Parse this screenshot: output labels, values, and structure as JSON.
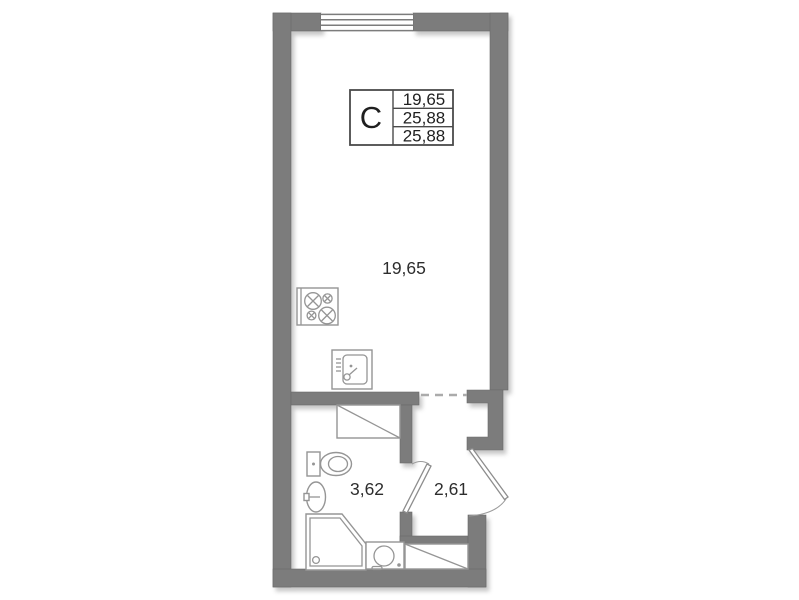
{
  "floorplan": {
    "unit_type_label": "C",
    "area_table": {
      "rows": [
        "19,65",
        "25,88",
        "25,88"
      ]
    },
    "rooms": [
      {
        "id": "living-room",
        "area_label": "19,65"
      },
      {
        "id": "bathroom",
        "area_label": "3,62"
      },
      {
        "id": "hallway",
        "area_label": "2,61"
      }
    ],
    "fixtures": [
      "window",
      "cooktop",
      "kitchen-sink",
      "wardrobe",
      "toilet",
      "washbasin",
      "shower-cabin",
      "washing-machine",
      "interior-door",
      "entrance-door",
      "storage-closet",
      "open-passage"
    ],
    "colors": {
      "wall": "#7c7c7c",
      "fixture_line": "#959595",
      "text": "#2d2d2d",
      "table_border": "#4a4a4a",
      "background": "#ffffff"
    }
  }
}
